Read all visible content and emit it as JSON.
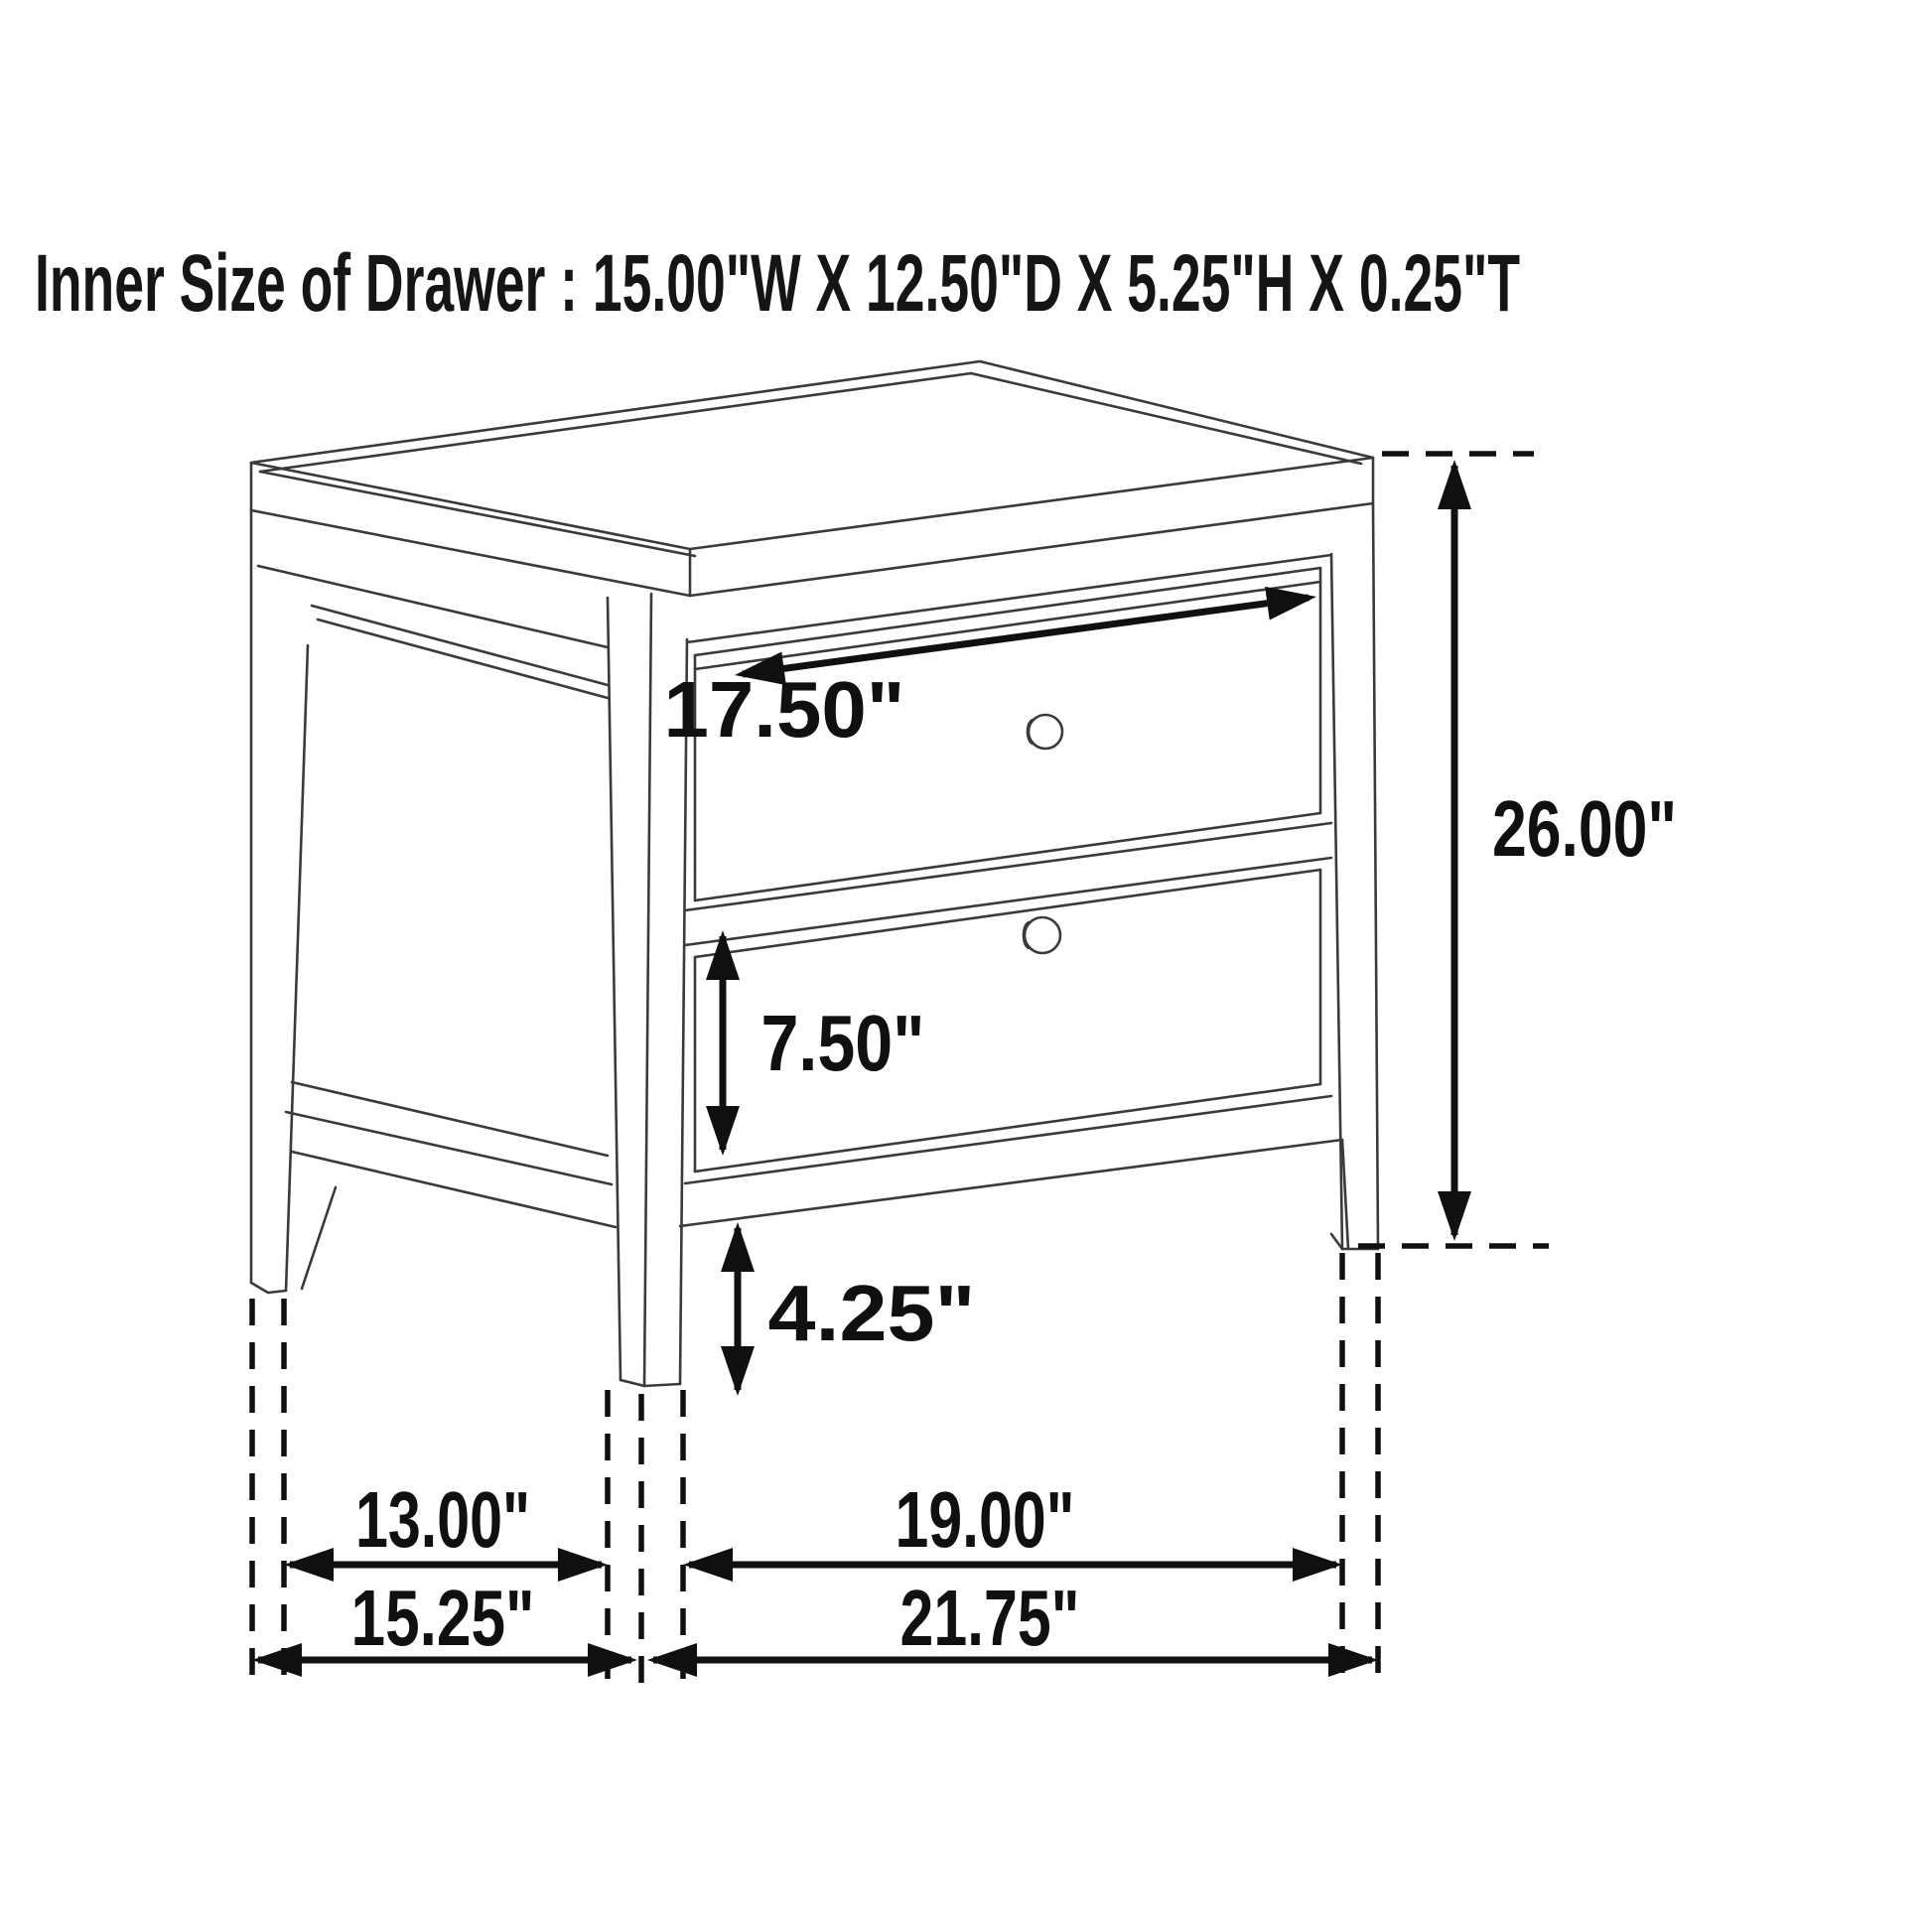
{
  "page": {
    "background": "#ffffff"
  },
  "title": {
    "text": "Inner Size of Drawer : 15.00\"W X 12.50\"D X 5.25\"H X 0.25\"T"
  },
  "diagram": {
    "type": "furniture-dimension-drawing",
    "subject": "two-drawer nightstand line drawing with measurement annotations",
    "colors": {
      "line": "#3a3a3a",
      "annotation": "#101010",
      "background": "#ffffff"
    },
    "dimensions": {
      "drawer_face_width": {
        "label": "17.50\""
      },
      "lower_drawer_face_height": {
        "label": "7.50\""
      },
      "floor_clearance": {
        "label": "4.25\""
      },
      "overall_height": {
        "label": "26.00\""
      },
      "side_leg_spacing": {
        "label": "13.00\""
      },
      "front_leg_spacing": {
        "label": "19.00\""
      },
      "overall_depth": {
        "label": "15.25\""
      },
      "overall_width": {
        "label": "21.75\""
      }
    }
  }
}
